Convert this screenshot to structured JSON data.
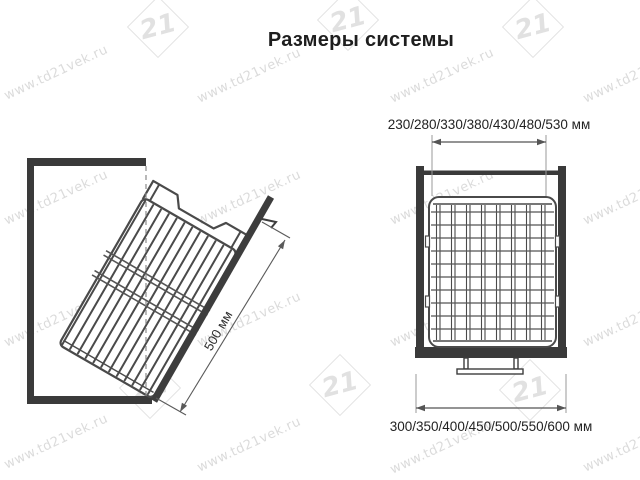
{
  "page": {
    "title": "Размеры системы"
  },
  "watermark": {
    "text": "www.td21vek.ru",
    "logo_number": "21"
  },
  "left_view": {
    "description": "side view, tilted wire basket on door inside cabinet",
    "dimension_label": "500 мм"
  },
  "right_view": {
    "description": "front view, wire basket inside cabinet on pedestal",
    "top_dimension_label": "230/280/330/380/430/480/530 мм",
    "bottom_dimension_label": "300/350/400/450/500/550/600 мм"
  },
  "colors": {
    "cabinet": "#3a3a3a",
    "wire": "#4a4a4a",
    "dimension_line": "#5a5a5a",
    "dimension_text": "#222222",
    "watermark": "#c4c4c4"
  }
}
